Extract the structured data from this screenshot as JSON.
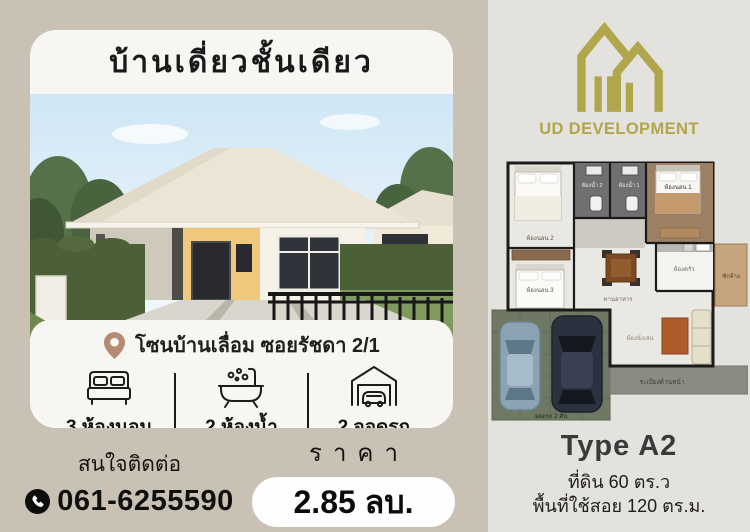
{
  "flyer": {
    "title": "บ้านเดี่ยวชั้นเดียว",
    "location": "โซนบ้านเลื่อม ซอยรัชดา 2/1",
    "features": [
      {
        "icon": "bed-icon",
        "label": "3 ห้องนอน"
      },
      {
        "icon": "bathtub-icon",
        "label": "2 ห้องน้ำ"
      },
      {
        "icon": "garage-icon",
        "label": "2 จอดรถ"
      }
    ],
    "contact": {
      "label": "สนใจติดต่อ",
      "phone": "061-6255590"
    },
    "price": {
      "label": "ราคา",
      "value": "2.85 ลบ."
    }
  },
  "right": {
    "brand": "UD DEVELOPMENT",
    "type": "Type A2",
    "land": "ที่ดิน 60 ตร.ว",
    "area": "พื้นที่ใช้สอย 120 ตร.ม.",
    "floorplan": {
      "bedroom1": "ห้องนอน 1",
      "bedroom2": "ห้องนอน 2",
      "bedroom3": "ห้องนอน 3",
      "bath1": "ห้องน้ำ 1",
      "bath2": "ห้องน้ำ 2",
      "kitchen": "ห้องครัว",
      "laundry": "ซักล้าง",
      "dining": "ทานอาหาร",
      "living": "ห้องนั่งเล่น",
      "porch": "ระเบียงด้านหน้า",
      "carport": "จอดรถ 2 คัน"
    }
  },
  "colors": {
    "background_tan": "#c9c1b4",
    "panel_gray": "#e4e2de",
    "card_white": "#f8f6f2",
    "accent_olive": "#b1a64b",
    "pin_brown": "#b28b72",
    "text_black": "#16150f"
  }
}
